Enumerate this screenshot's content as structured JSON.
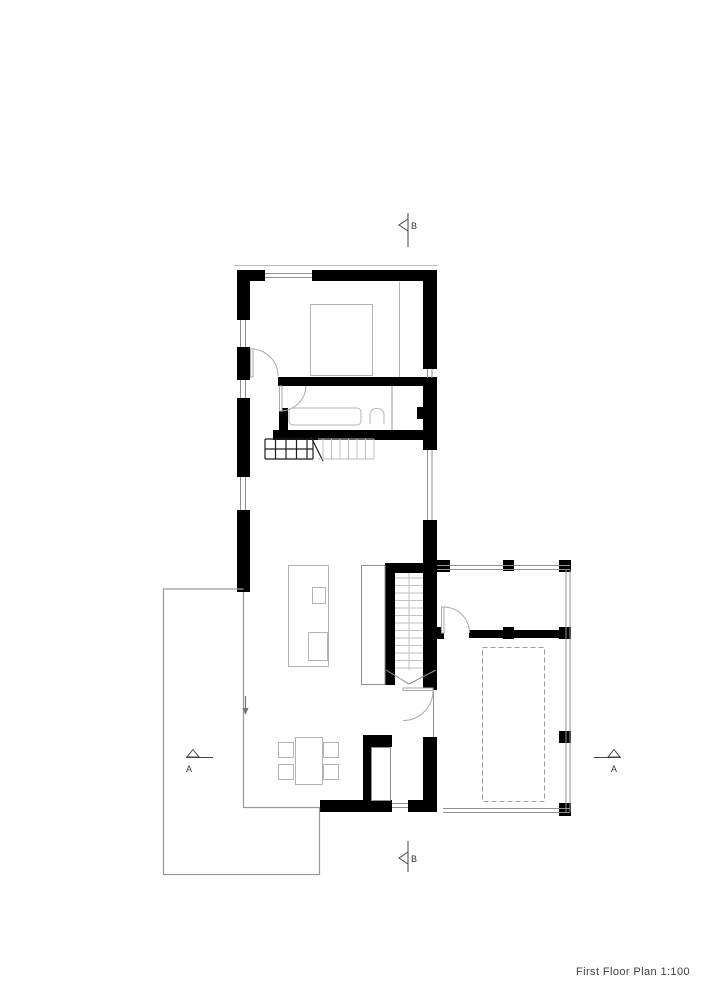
{
  "title_block": {
    "title": "First Floor Plan 1:100"
  },
  "section_markers": {
    "b_top": {
      "label": "B"
    },
    "b_bottom": {
      "label": "B"
    },
    "a_left": {
      "label": "A"
    },
    "a_right": {
      "label": "A"
    }
  },
  "colors": {
    "background": "#ffffff",
    "wall": "#000000",
    "thin_line": "#909090",
    "glass_line": "#9a9a9a",
    "furniture": "#b4b4b4",
    "treads": "#c2c2c2",
    "stair_dark": "#1f1f1f",
    "door_arc": "#aaaaaa",
    "dashed": "#9a9a9a",
    "eave": "#bbbbbb",
    "marker": "#444444"
  }
}
